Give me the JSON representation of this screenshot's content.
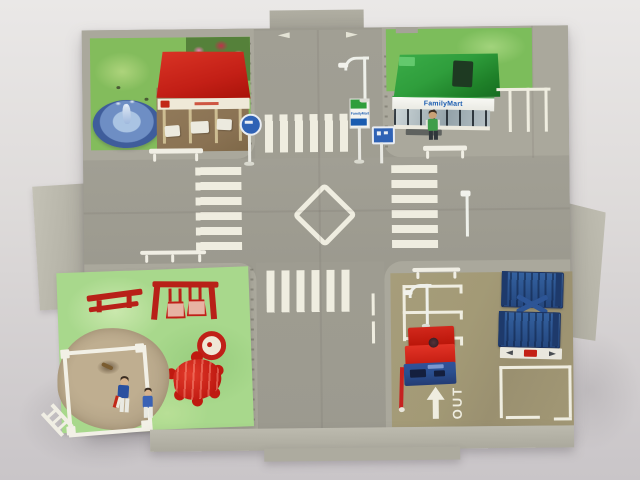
{
  "scene": {
    "description": "Overhead photograph of a fold-out toy town playset with a four-way road intersection",
    "regions": {
      "top_left": "park with fountain, flower bed and red-roofed stand",
      "top_right": "FamilyMart convenience store with parking spaces",
      "bottom_left": "playground mat with sandbox and two figures",
      "bottom_right": "parking lot with folded blue lift, red gate and OUT exit marking"
    }
  },
  "labels": {
    "store_sign": "FamilyMart",
    "exit_marking": "OUT"
  },
  "colors": {
    "backdrop-top": "#eae8e7",
    "backdrop-bottom": "#c9c5c8",
    "plate": "#aaa89c",
    "plate-light": "#bcbaae",
    "road": "#9c9a8f",
    "marking": "#efede0",
    "white-paint": "#f0eee4",
    "park-grass": "#83bc5c",
    "play-grass": "#a8d88c",
    "parking-lot": "#a39a76",
    "store-green": "#2f9e3c",
    "store-blue": "#1a5cb0",
    "pavilion-red": "#c31f16",
    "toy-red": "#cf2020",
    "toy-blue": "#2a4f8f",
    "fountain-dark": "#3f5d9b",
    "fountain-mid": "#6e8ec4",
    "fountain-water": "#aac4e3",
    "sand": "#b3a387",
    "dirt": "#8a7253"
  }
}
